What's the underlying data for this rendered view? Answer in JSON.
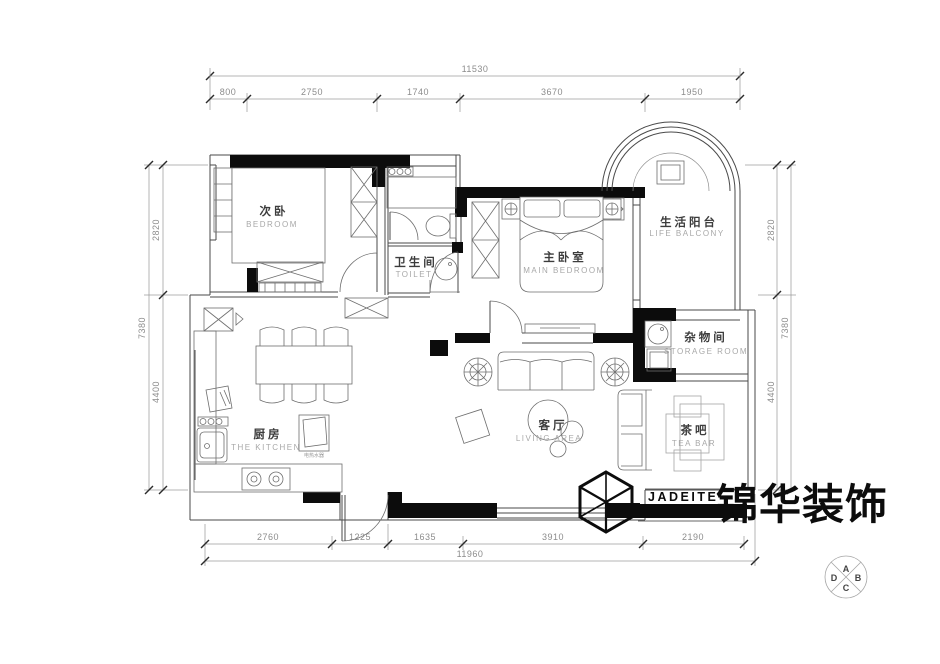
{
  "rooms": {
    "bedroom": {
      "zh": "次卧",
      "en": "BEDROOM"
    },
    "toilet": {
      "zh": "卫生间",
      "en": "TOILET"
    },
    "main_bedroom": {
      "zh": "主卧室",
      "en": "MAIN BEDROOM"
    },
    "balcony": {
      "zh": "生活阳台",
      "en": "LIFE BALCONY"
    },
    "storage": {
      "zh": "杂物间",
      "en": "STORAGE ROOM"
    },
    "kitchen": {
      "zh": "厨房",
      "en": "THE KITCHEN"
    },
    "living": {
      "zh": "客厅",
      "en": "LIVING AREA"
    },
    "tea_bar": {
      "zh": "茶吧",
      "en": "TEA BAR"
    }
  },
  "equipment": {
    "water_heater": "电热水器"
  },
  "dims": {
    "top": {
      "overall": "11530",
      "segments": [
        "800",
        "2750",
        "1740",
        "3670",
        "1950"
      ]
    },
    "bottom": {
      "overall": "11960",
      "segments": [
        "2760",
        "1225",
        "1635",
        "3910",
        "2190"
      ]
    },
    "left": {
      "overall": "7380",
      "segments": [
        "2820",
        "4400"
      ]
    },
    "right": {
      "overall": "7380",
      "segments": [
        "2820",
        "4400"
      ]
    }
  },
  "logo": {
    "brand_en": "JADEITE",
    "brand_zh": "锦华装饰"
  },
  "compass": {
    "top": "A",
    "right": "B",
    "bottom": "C",
    "left": "D"
  },
  "colors": {
    "wall": "#0c0c0c",
    "line": "#4a4a4a",
    "dim_text": "#8c8c8c",
    "label_zh": "#3c3c3c",
    "label_en": "#a8a8a8"
  }
}
